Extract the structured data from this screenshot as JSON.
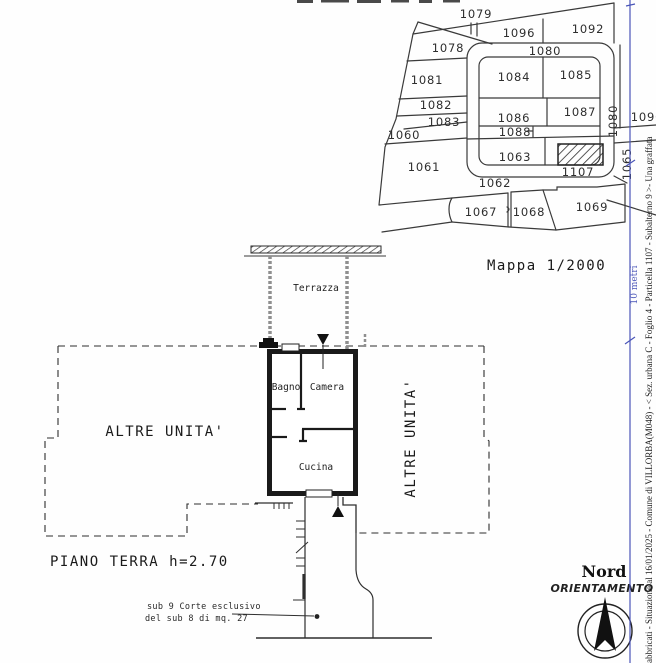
{
  "map": {
    "title": "Mappa 1/2000",
    "parcels": {
      "p1060": "1060",
      "p1061": "1061",
      "p1062": "1062",
      "p1063": "1063",
      "p1065": "1065",
      "p1067": "1067",
      "p1068": "1068",
      "p1069": "1069",
      "p1078": "1078",
      "p1079": "1079",
      "p1080_top": "1080",
      "p1080_right": "1080",
      "p1081": "1081",
      "p1082": "1082",
      "p1083": "1083",
      "p1084": "1084",
      "p1085": "1085",
      "p1086": "1086",
      "p1087": "1087",
      "p1088": "1088",
      "p1090": "1090",
      "p1092": "1092",
      "p1096": "1096",
      "p1107": "1107"
    }
  },
  "scale_bar": {
    "label": "10 metri"
  },
  "floor_plan": {
    "terrazza": "Terrazza",
    "bagno": "Bagno",
    "camera": "Camera",
    "cucina": "Cucina",
    "altre_unita_left": "ALTRE UNITA'",
    "altre_unita_right": "ALTRE UNITA'",
    "floor_label": "PIANO TERRA h=2.70",
    "court_note_line1": "sub 9 Corte esclusivo",
    "court_note_line2": "del sub 8 di mq. 27"
  },
  "orientation": {
    "north": "Nord",
    "label": "ORIENTAMENTO"
  },
  "footer": {
    "vertical_text": "Fabbricati - Situazione al 16/01/2025 - Comune di VILLORBA(M048) - < Sez. urbana C - Foglio 4 - Particella 1107 - Subalterno 9 >- Una graffata"
  },
  "colors": {
    "ink": "#3a3a3a",
    "scale_blue": "#4a55b8",
    "wall_gray": "#8f8f8f",
    "wall_black": "#1a1a1a"
  }
}
